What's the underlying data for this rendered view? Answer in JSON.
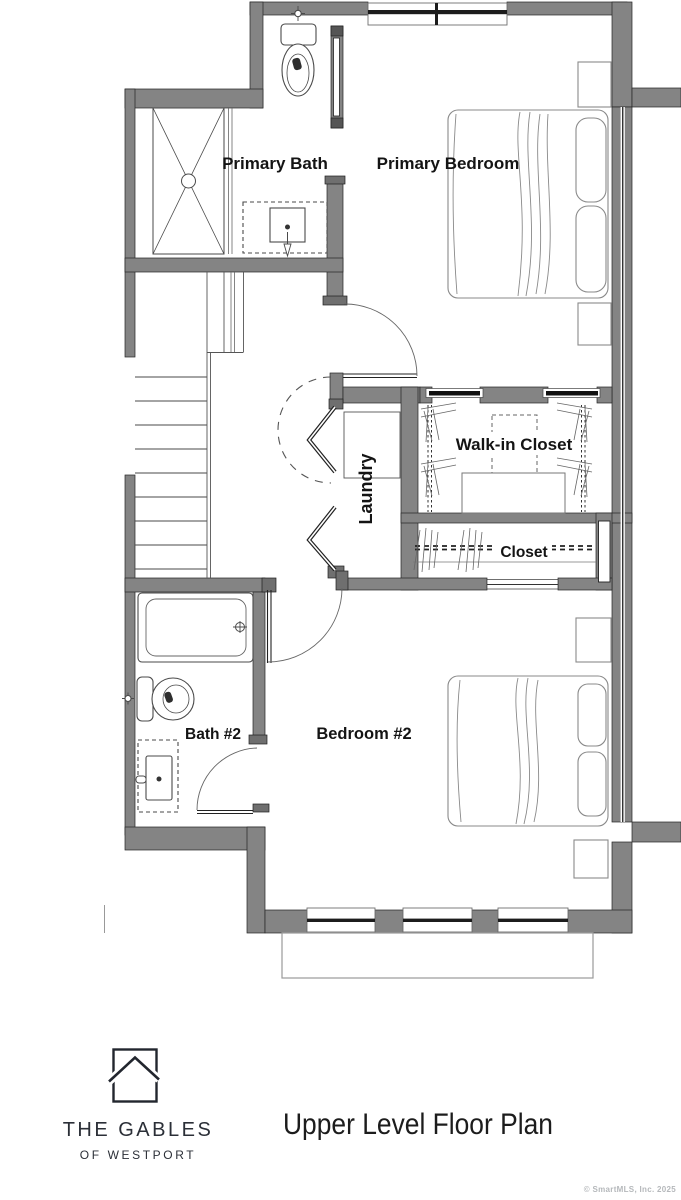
{
  "plan": {
    "rooms": {
      "primary_bath": "Primary Bath",
      "primary_bedroom": "Primary Bedroom",
      "walk_in_closet": "Walk-in Closet",
      "laundry": "Laundry",
      "closet": "Closet",
      "bath_2": "Bath #2",
      "bedroom_2": "Bedroom #2"
    },
    "fixtures": [
      "shower",
      "toilet",
      "vanity-sink",
      "bathtub",
      "washer-dryer",
      "bed",
      "nightstand",
      "stairs",
      "closet-rod",
      "deck"
    ],
    "colors": {
      "wall": "#848484",
      "fixture_line": "#4a4a4a",
      "furniture_line": "#8a8a8a"
    }
  },
  "footer": {
    "logo_icon": "house-outline-icon",
    "brand_line1": "THE GABLES",
    "brand_line2": "OF WESTPORT",
    "title": "Upper Level Floor Plan",
    "copyright": "© SmartMLS, Inc.  2025"
  }
}
